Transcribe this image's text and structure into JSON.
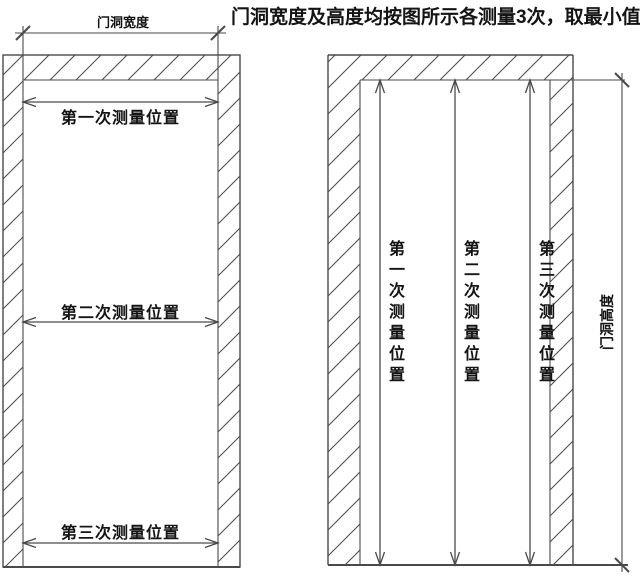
{
  "title": "门洞宽度及高度均按图所示各测量3次，取最小值",
  "colors": {
    "background": "#ffffff",
    "line": "#4a4a4b",
    "text": "#141414"
  },
  "left_diagram": {
    "width_dimension_label": "门洞宽度",
    "measurements": [
      {
        "label": "第一次测量位置"
      },
      {
        "label": "第二次测量位置"
      },
      {
        "label": "第三次测量位置"
      }
    ]
  },
  "right_diagram": {
    "height_dimension_label": "门洞高度",
    "measurements": [
      {
        "label": "第一次测量位置"
      },
      {
        "label": "第二次测量位置"
      },
      {
        "label": "第三次测量位置"
      }
    ]
  }
}
